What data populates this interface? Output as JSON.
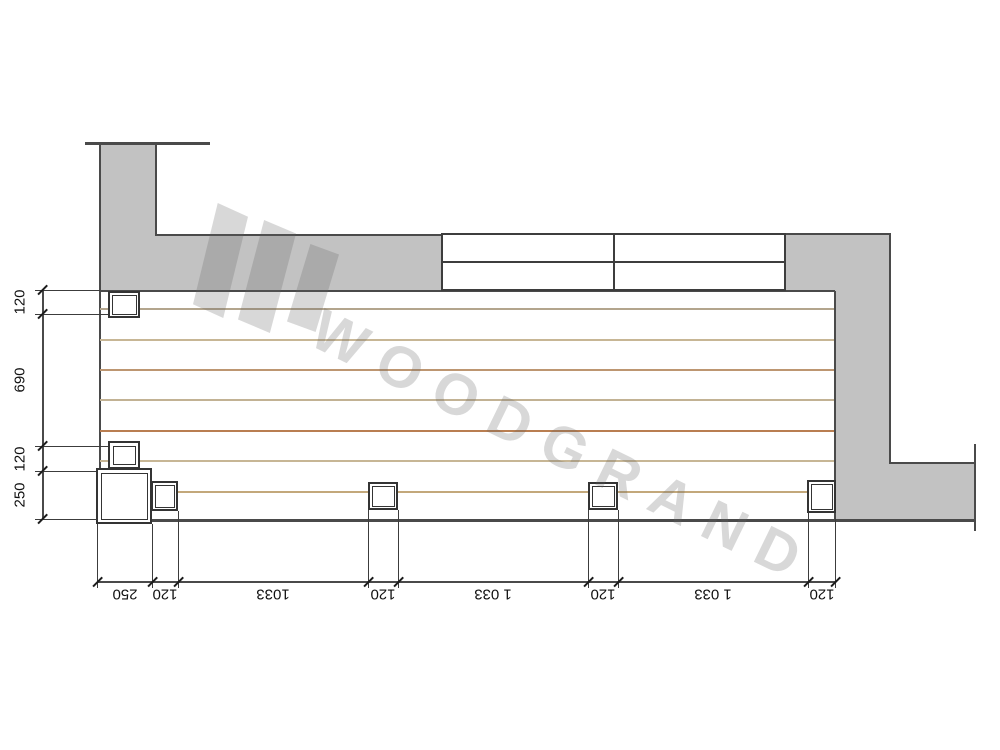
{
  "watermark": {
    "text": "WOODGRAND",
    "color": "rgba(100,100,100,0.25)",
    "logo_shapes": [
      {
        "x": 193,
        "y": 203,
        "w": 55,
        "h": 115
      },
      {
        "x": 238,
        "y": 220,
        "w": 58,
        "h": 113
      },
      {
        "x": 287,
        "y": 244,
        "w": 52,
        "h": 88
      }
    ]
  },
  "colors": {
    "wall_fill": "#c2c2c2",
    "outline": "#4a4a4a",
    "dim_text": "#111111"
  },
  "deck": {
    "planks": [
      {
        "y": 308,
        "color": "#b3a58d"
      },
      {
        "y": 339,
        "color": "#c7b695"
      },
      {
        "y": 369,
        "color": "#bd9671"
      },
      {
        "y": 399,
        "color": "#c2b294"
      },
      {
        "y": 430,
        "color": "#b97e51"
      },
      {
        "y": 460,
        "color": "#c7b695"
      },
      {
        "y": 491,
        "color": "#c3a87b"
      }
    ],
    "posts": [
      {
        "x": 108,
        "y": 291,
        "w": 32,
        "h": 27,
        "inset": 4
      },
      {
        "x": 108,
        "y": 441,
        "w": 32,
        "h": 28,
        "inset": 5
      },
      {
        "x": 96,
        "y": 468,
        "w": 56,
        "h": 56,
        "inset": 5
      },
      {
        "x": 151,
        "y": 481,
        "w": 27,
        "h": 30,
        "inset": 4
      },
      {
        "x": 368,
        "y": 482,
        "w": 30,
        "h": 28,
        "inset": 4
      },
      {
        "x": 588,
        "y": 482,
        "w": 30,
        "h": 28,
        "inset": 4
      },
      {
        "x": 807,
        "y": 480,
        "w": 29,
        "h": 33,
        "inset": 4
      }
    ]
  },
  "dimensions": {
    "left": {
      "line": {
        "x": 42,
        "from": 290,
        "to": 519
      },
      "labels": [
        {
          "text": "120",
          "from": 290,
          "to": 314
        },
        {
          "text": "690",
          "from": 314,
          "to": 446
        },
        {
          "text": "120",
          "from": 446,
          "to": 471
        },
        {
          "text": "250",
          "from": 471,
          "to": 519
        }
      ],
      "ext_lines": [
        {
          "y": 290,
          "x1": 35,
          "x2": 100
        },
        {
          "y": 314,
          "x1": 35,
          "x2": 108
        },
        {
          "y": 446,
          "x1": 35,
          "x2": 108
        },
        {
          "y": 471,
          "x1": 35,
          "x2": 96
        },
        {
          "y": 519,
          "x1": 35,
          "x2": 97
        }
      ]
    },
    "bottom": {
      "line": {
        "y": 581,
        "from": 97,
        "to": 835
      },
      "labels": [
        {
          "text": "250",
          "from": 97,
          "to": 152
        },
        {
          "text": "120",
          "from": 152,
          "to": 178
        },
        {
          "text": "1033",
          "from": 178,
          "to": 368
        },
        {
          "text": "120",
          "from": 368,
          "to": 398
        },
        {
          "text": "1 033",
          "from": 398,
          "to": 588
        },
        {
          "text": "120",
          "from": 588,
          "to": 618
        },
        {
          "text": "1 033",
          "from": 618,
          "to": 808
        },
        {
          "text": "120",
          "from": 808,
          "to": 835
        }
      ],
      "ext_lines": [
        {
          "x": 97,
          "y1": 524,
          "y2": 588
        },
        {
          "x": 152,
          "y1": 524,
          "y2": 588
        },
        {
          "x": 178,
          "y1": 511,
          "y2": 588
        },
        {
          "x": 368,
          "y1": 510,
          "y2": 588
        },
        {
          "x": 398,
          "y1": 510,
          "y2": 588
        },
        {
          "x": 588,
          "y1": 510,
          "y2": 588
        },
        {
          "x": 618,
          "y1": 510,
          "y2": 588
        },
        {
          "x": 808,
          "y1": 513,
          "y2": 588
        },
        {
          "x": 835,
          "y1": 519,
          "y2": 588
        }
      ]
    }
  }
}
